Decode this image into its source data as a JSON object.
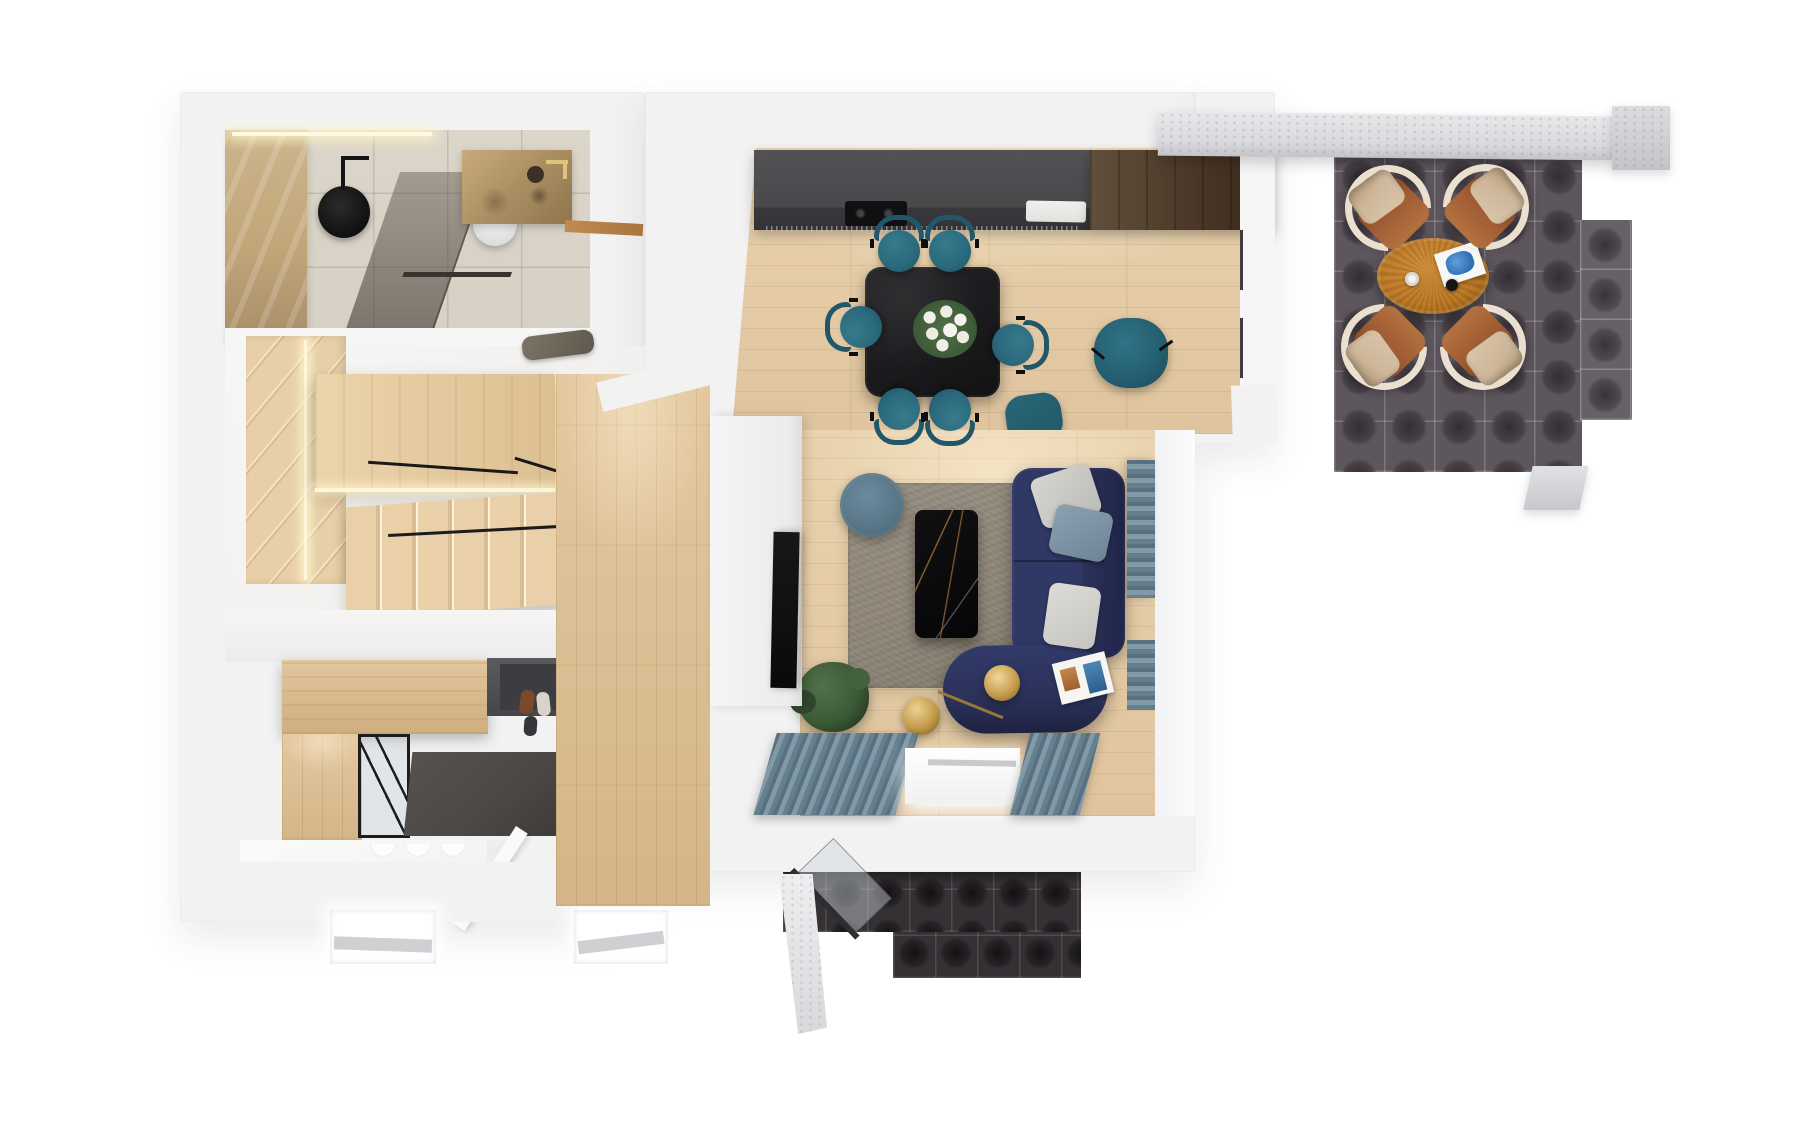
{
  "meta": {
    "kind": "3d-floor-plan-render",
    "view": "top-down",
    "background": "#ffffff"
  },
  "palette": {
    "wall": "#f2f2f3",
    "wallLight": "#f6f6f7",
    "woodFloor": "#dfc49e",
    "woodFloorDark": "#d3b588",
    "woodStair": "#e7cfa7",
    "walnut": "#4b3828",
    "counter": "#49494c",
    "applianceBlack": "#101013",
    "diningTable": "#1a1a1d",
    "chairTeal": "#2b6a7d",
    "chairTealDark": "#21576a",
    "sofaNavy": "#2b3158",
    "rug": "#8f8679",
    "curtain": "#74899a",
    "curtainDark": "#58707f",
    "gold": "#c49a4a",
    "accentRed": "#d95038",
    "plantGreen": "#3c5a36",
    "matGray": "#4b4745",
    "terraceTile": "#5d565d",
    "terraceTileInner": "#332e33",
    "southTile": "#343034",
    "southTileInner": "#131013",
    "rattan": "#c07c28",
    "leather": "#a05c34",
    "cream": "#ebdfd0",
    "cushionBeige": "#cdb69a",
    "concrete": "#d8d9dc",
    "marbleBeige": "#c2a679",
    "bathFloor": "#d7d1c5"
  },
  "scene": {
    "rooms": [
      "bathroom",
      "staircase",
      "entry-hall",
      "storage-room",
      "corridor",
      "kitchen",
      "dining-area",
      "living-room",
      "east-terrace",
      "south-terrace"
    ],
    "dining_chairs": [
      {
        "x": 899,
        "y": 247,
        "rot": 0
      },
      {
        "x": 950,
        "y": 247,
        "rot": 0
      },
      {
        "x": 857,
        "y": 327,
        "rot": 270
      },
      {
        "x": 1017,
        "y": 345,
        "rot": 90
      },
      {
        "x": 899,
        "y": 413,
        "rot": 180
      },
      {
        "x": 950,
        "y": 414,
        "rot": 180
      }
    ],
    "terrace_chairs": [
      {
        "x": 1388,
        "y": 208,
        "rot": 135
      },
      {
        "x": 1486,
        "y": 207,
        "rot": 225
      },
      {
        "x": 1384,
        "y": 347,
        "rot": 45
      },
      {
        "x": 1483,
        "y": 347,
        "rot": 315
      }
    ]
  }
}
